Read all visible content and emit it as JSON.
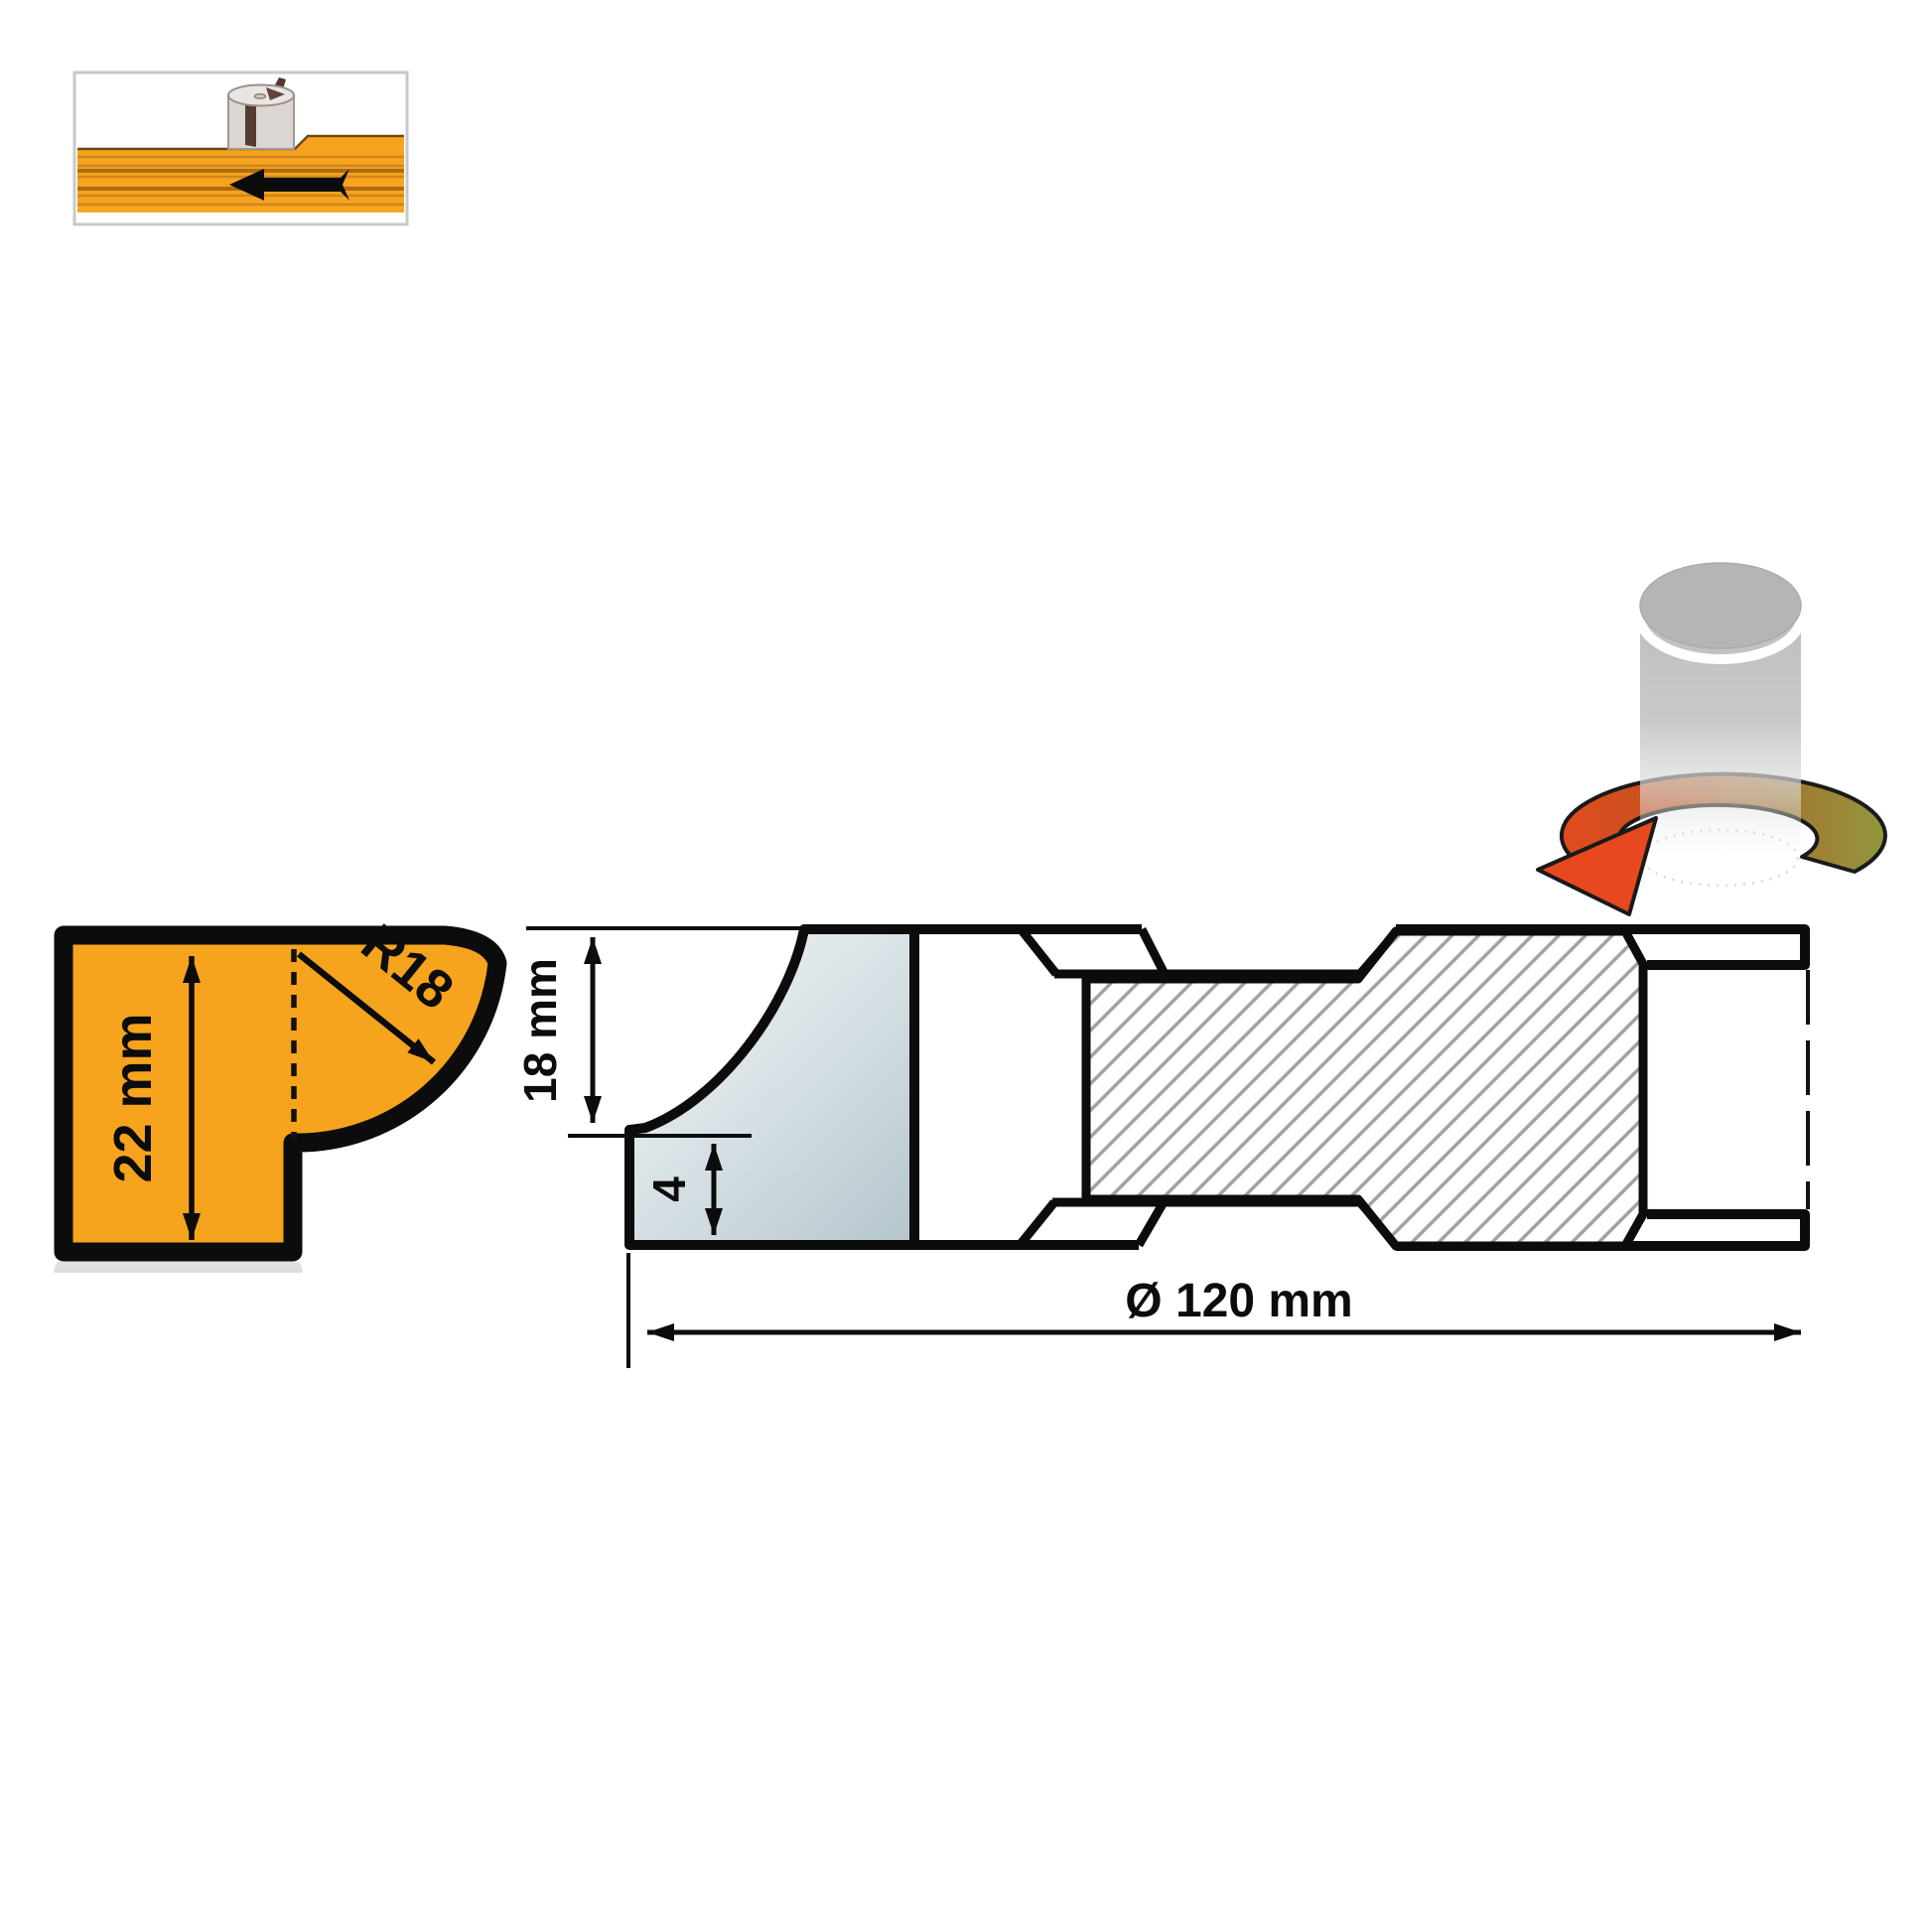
{
  "figure": {
    "title": "router-cutter-profile-diagram",
    "profile": {
      "height_label": "22 mm",
      "radius_label": "R18"
    },
    "section": {
      "cut_height_label": "18 mm",
      "step_label": "4",
      "diameter_label": "Ø 120 mm"
    }
  },
  "icons": {
    "feed_direction": "feed-arrow-left",
    "rotation": "rotation-arrow"
  },
  "colors": {
    "wood": "#F6A41E",
    "wood-grain": "#D08420",
    "wood-grain-dark": "#B06A14",
    "steel-light": "#F1F5F6",
    "steel-mid": "#D6E0E4",
    "steel-dark": "#B3C4CC",
    "outline": "#0C0C0C",
    "hatch": "#9BA3A8",
    "arrow-red": "#E8481E",
    "arrow-olive": "#93953E",
    "frame-border": "#C8C8C8",
    "cylinder-gray": "#B5B5B5"
  }
}
